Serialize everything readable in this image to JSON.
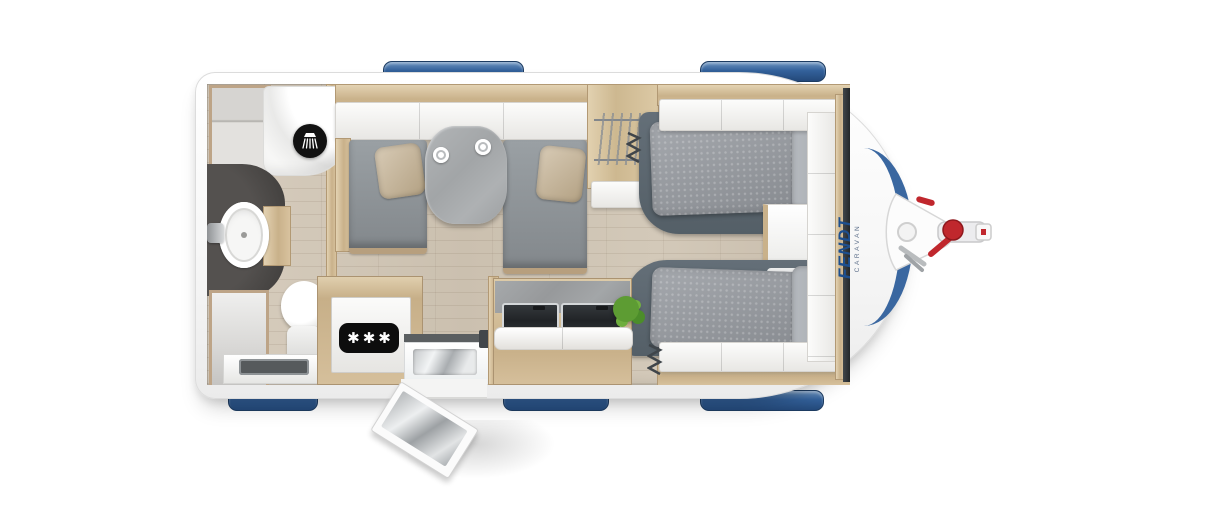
{
  "scene": {
    "type": "caravan-floorplan-top-view",
    "orientation": "drawbar hitch on the right (front), rear bathroom on the left"
  },
  "logo": {
    "name": "FENDT",
    "tagline": "CARAVAN"
  },
  "labels": {
    "freezer_stars": "✱✱✱"
  },
  "icons": {
    "shower": "shower-head-icon",
    "freezer": "freezer-stars-badge",
    "hitch": "drawbar-coupling-with-jockey-wheel"
  },
  "palette": {
    "background": "#ffffff",
    "body_white": "#fbfbfb",
    "window_blue": "#33619b",
    "logo_blue": "#1d4f8f",
    "floor_wood": "#cfc5b5",
    "cabinet_wood": "#cdb890",
    "upholstery_grey": "#8f9397",
    "bed_frame_grey": "#5c6770",
    "vanity_dark": "#4a4a4a",
    "hitch_red": "#c0272d",
    "plant_green": "#5d9c33"
  },
  "rooms": {
    "bathroom": [
      "shower-cubicle",
      "washbasin",
      "toilet",
      "cabinets",
      "counter-sink"
    ],
    "lounge": [
      "sofa-left",
      "sofa-right",
      "dining-table",
      "two-cups",
      "two-cushions",
      "overhead-lockers"
    ],
    "kitchen": [
      "refrigerator-freezer",
      "sink-by-door",
      "hob-with-two-glass-lids",
      "green-plant"
    ],
    "bedroom": [
      "single-bed-top",
      "single-bed-bottom",
      "wardrobe-with-hangers",
      "nightstand",
      "front-lockers"
    ]
  },
  "exterior": {
    "windows_top": 2,
    "windows_bottom": 3,
    "front_window": 1,
    "entry_door": "open, bottom side",
    "hitch": "white cover, red brake lever and coupling handle"
  }
}
